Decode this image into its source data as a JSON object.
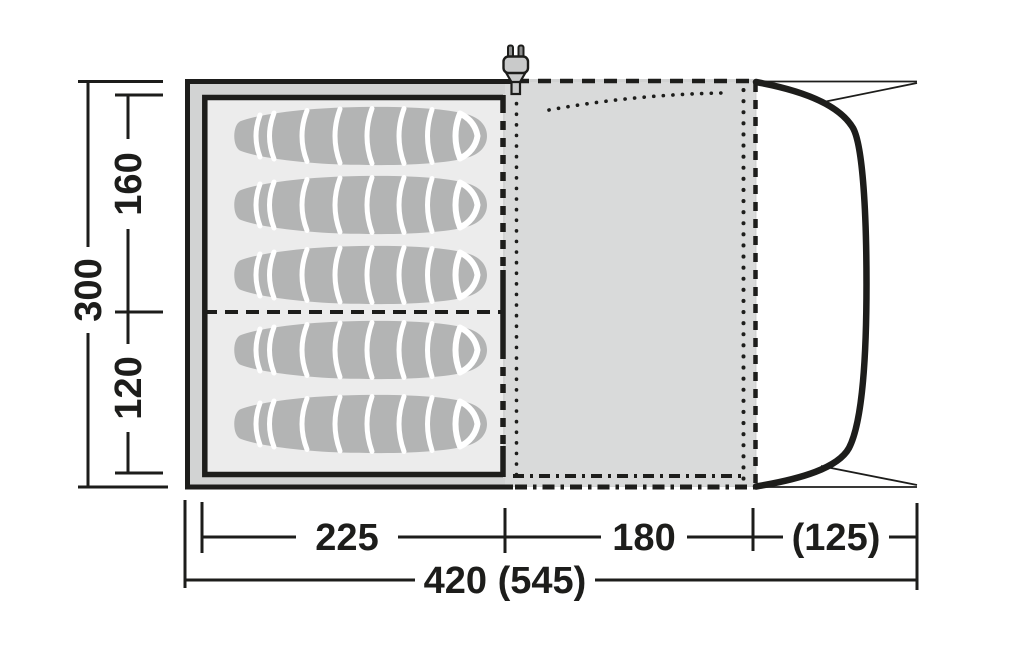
{
  "diagram": {
    "kind": "tent-floorplan",
    "sleeping_bag_count": 5,
    "zones": [
      "sleeping-cabin",
      "living-area",
      "front-canopy"
    ],
    "power_icon": "power-plug-icon"
  },
  "dimensions": {
    "depth_total": "300",
    "depth_bedroom_rear": "160",
    "depth_bedroom_front": "120",
    "width_bedroom": "225",
    "width_living_area": "180",
    "width_canopy": "(125)",
    "width_total": "420 (545)"
  },
  "colors": {
    "line": "#1d1d1b",
    "outer_fabric": "#d2d3d3",
    "living_floor": "#d9dada",
    "inner_floor": "#ececec",
    "sleeping_bag": "#b3b4b4",
    "canvas": "#ffffff"
  }
}
